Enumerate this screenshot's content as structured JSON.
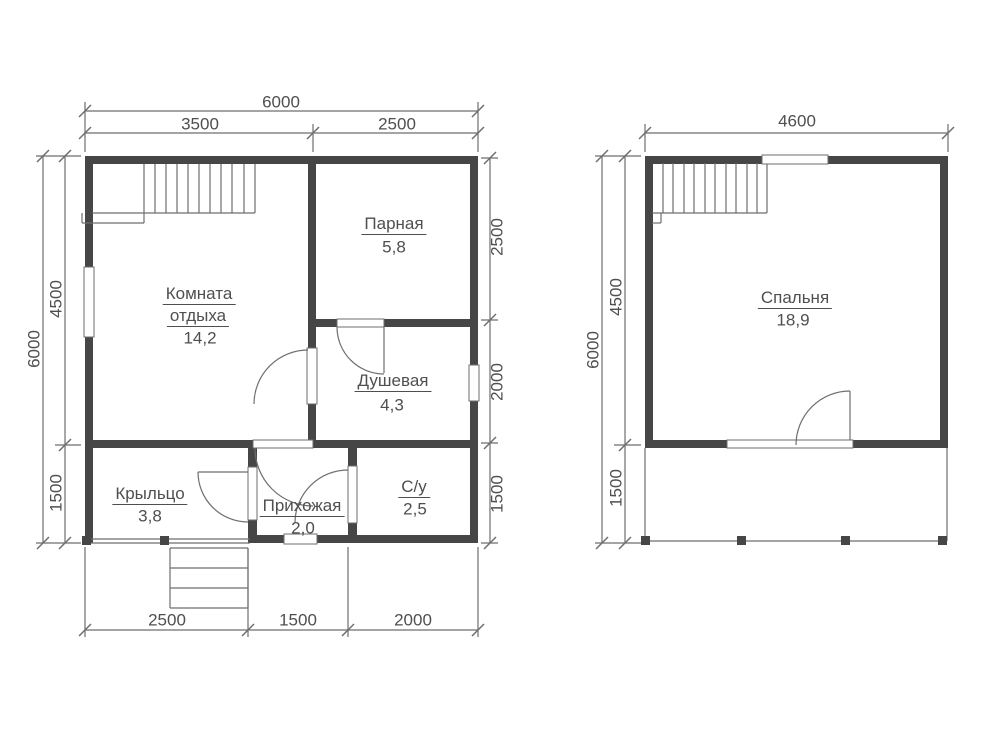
{
  "title": "Floor plans of a 6x6 bath house, two levels",
  "colors": {
    "wall": "#464646",
    "thin": "#6e6e6e",
    "text": "#4f4f4f",
    "window_fill": "#ffffff",
    "bg": "#ffffff"
  },
  "drawing": {
    "walls": [
      {
        "n": "plan1-top-wall",
        "x": 85,
        "y": 156,
        "w": 393,
        "h": 8
      },
      {
        "n": "plan1-left-wall",
        "x": 85,
        "y": 156,
        "w": 8,
        "h": 387
      },
      {
        "n": "plan1-right-wall",
        "x": 470,
        "y": 156,
        "w": 8,
        "h": 387
      },
      {
        "n": "plan1-bottom-wall",
        "x": 250,
        "y": 535,
        "w": 228,
        "h": 8
      },
      {
        "n": "plan1-mid-wall",
        "x": 85,
        "y": 440,
        "w": 393,
        "h": 8
      },
      {
        "n": "plan1-divider-wall",
        "x": 308,
        "y": 156,
        "w": 8,
        "h": 292
      },
      {
        "n": "plan1-sauna-shower-wall",
        "x": 308,
        "y": 319,
        "w": 170,
        "h": 8
      },
      {
        "n": "plan1-hall-left-wall",
        "x": 248,
        "y": 440,
        "w": 9,
        "h": 103
      },
      {
        "n": "plan1-hall-right-wall",
        "x": 348,
        "y": 440,
        "w": 9,
        "h": 103
      },
      {
        "n": "plan2-top-wall",
        "x": 645,
        "y": 156,
        "w": 303,
        "h": 8
      },
      {
        "n": "plan2-left-wall",
        "x": 645,
        "y": 156,
        "w": 8,
        "h": 292
      },
      {
        "n": "plan2-right-wall",
        "x": 940,
        "y": 156,
        "w": 8,
        "h": 292
      },
      {
        "n": "plan2-bottom-wall",
        "x": 645,
        "y": 440,
        "w": 303,
        "h": 8
      }
    ],
    "windows": [
      {
        "n": "window-left",
        "x": 84,
        "y": 267,
        "w": 10,
        "h": 70
      },
      {
        "n": "window-right",
        "x": 469,
        "y": 365,
        "w": 10,
        "h": 36
      },
      {
        "n": "door-opening-lounge-hall",
        "x": 253,
        "y": 440,
        "w": 60,
        "h": 8
      },
      {
        "n": "door-opening-lounge-shower",
        "x": 307,
        "y": 348,
        "w": 10,
        "h": 56
      },
      {
        "n": "door-opening-sauna",
        "x": 337,
        "y": 319,
        "w": 47,
        "h": 8
      },
      {
        "n": "door-opening-wc",
        "x": 348,
        "y": 466,
        "w": 9,
        "h": 57
      },
      {
        "n": "door-opening-porch",
        "x": 248,
        "y": 467,
        "w": 9,
        "h": 53
      },
      {
        "n": "entrance-opening",
        "x": 284,
        "y": 534,
        "w": 33,
        "h": 10
      },
      {
        "n": "window-top-plan2",
        "x": 762,
        "y": 155,
        "w": 66,
        "h": 9
      },
      {
        "n": "door-opening-bedroom",
        "x": 727,
        "y": 440,
        "w": 126,
        "h": 8
      }
    ],
    "posts": [
      {
        "n": "porch-post",
        "x": 82,
        "y": 536,
        "w": 9,
        "h": 9
      },
      {
        "n": "porch-post",
        "x": 160,
        "y": 536,
        "w": 9,
        "h": 9
      },
      {
        "n": "terrace-post",
        "x": 641,
        "y": 536,
        "w": 9,
        "h": 9
      },
      {
        "n": "terrace-post",
        "x": 737,
        "y": 536,
        "w": 9,
        "h": 9
      },
      {
        "n": "terrace-post",
        "x": 841,
        "y": 536,
        "w": 9,
        "h": 9
      },
      {
        "n": "terrace-post",
        "x": 938,
        "y": 536,
        "w": 9,
        "h": 9
      }
    ],
    "lines": [
      {
        "n": "dim-line",
        "x1": 43,
        "y1": 156,
        "x2": 43,
        "y2": 543
      },
      {
        "n": "dim-line",
        "x1": 65,
        "y1": 156,
        "x2": 65,
        "y2": 543
      },
      {
        "n": "dim-line",
        "x1": 85,
        "y1": 111,
        "x2": 478,
        "y2": 111
      },
      {
        "n": "dim-line",
        "x1": 85,
        "y1": 133,
        "x2": 478,
        "y2": 133
      },
      {
        "n": "dim-line",
        "x1": 490,
        "y1": 158,
        "x2": 490,
        "y2": 543
      },
      {
        "n": "dim-line",
        "x1": 85,
        "y1": 630,
        "x2": 478,
        "y2": 630
      },
      {
        "n": "dim-line",
        "x1": 602,
        "y1": 156,
        "x2": 602,
        "y2": 543
      },
      {
        "n": "dim-line",
        "x1": 625,
        "y1": 156,
        "x2": 625,
        "y2": 543
      },
      {
        "n": "dim-line",
        "x1": 645,
        "y1": 133,
        "x2": 948,
        "y2": 133
      },
      {
        "n": "ext-line",
        "x1": 85,
        "y1": 102,
        "x2": 85,
        "y2": 152
      },
      {
        "n": "ext-line",
        "x1": 478,
        "y1": 102,
        "x2": 478,
        "y2": 152
      },
      {
        "n": "ext-line",
        "x1": 313,
        "y1": 124,
        "x2": 313,
        "y2": 152
      },
      {
        "n": "ext-line",
        "x1": 36,
        "y1": 156,
        "x2": 81,
        "y2": 156
      },
      {
        "n": "ext-line",
        "x1": 36,
        "y1": 543,
        "x2": 81,
        "y2": 543
      },
      {
        "n": "ext-line",
        "x1": 55,
        "y1": 445,
        "x2": 81,
        "y2": 445
      },
      {
        "n": "ext-line",
        "x1": 481,
        "y1": 158,
        "x2": 498,
        "y2": 158
      },
      {
        "n": "ext-line",
        "x1": 481,
        "y1": 320,
        "x2": 498,
        "y2": 320
      },
      {
        "n": "ext-line",
        "x1": 481,
        "y1": 443,
        "x2": 498,
        "y2": 443
      },
      {
        "n": "ext-line",
        "x1": 481,
        "y1": 543,
        "x2": 498,
        "y2": 543
      },
      {
        "n": "ext-line",
        "x1": 85,
        "y1": 547,
        "x2": 85,
        "y2": 637
      },
      {
        "n": "ext-line",
        "x1": 248,
        "y1": 548,
        "x2": 248,
        "y2": 637
      },
      {
        "n": "ext-line",
        "x1": 348,
        "y1": 547,
        "x2": 348,
        "y2": 637
      },
      {
        "n": "ext-line",
        "x1": 478,
        "y1": 547,
        "x2": 478,
        "y2": 637
      },
      {
        "n": "ext-line",
        "x1": 645,
        "y1": 124,
        "x2": 645,
        "y2": 152
      },
      {
        "n": "ext-line",
        "x1": 948,
        "y1": 124,
        "x2": 948,
        "y2": 152
      },
      {
        "n": "ext-line",
        "x1": 595,
        "y1": 156,
        "x2": 641,
        "y2": 156
      },
      {
        "n": "ext-line",
        "x1": 595,
        "y1": 543,
        "x2": 641,
        "y2": 543
      },
      {
        "n": "ext-line",
        "x1": 614,
        "y1": 445,
        "x2": 641,
        "y2": 445
      },
      {
        "n": "stair-line",
        "x1": 92,
        "y1": 213,
        "x2": 255,
        "y2": 213
      },
      {
        "n": "stair-line",
        "x1": 255,
        "y1": 164,
        "x2": 255,
        "y2": 213
      },
      {
        "n": "stair-line",
        "x1": 144,
        "y1": 164,
        "x2": 144,
        "y2": 213
      },
      {
        "n": "stair-tread",
        "x1": 155,
        "y1": 164,
        "x2": 155,
        "y2": 213
      },
      {
        "n": "stair-tread",
        "x1": 166,
        "y1": 164,
        "x2": 166,
        "y2": 213
      },
      {
        "n": "stair-tread",
        "x1": 177,
        "y1": 164,
        "x2": 177,
        "y2": 213
      },
      {
        "n": "stair-tread",
        "x1": 188,
        "y1": 164,
        "x2": 188,
        "y2": 213
      },
      {
        "n": "stair-tread",
        "x1": 199,
        "y1": 164,
        "x2": 199,
        "y2": 213
      },
      {
        "n": "stair-tread",
        "x1": 210,
        "y1": 164,
        "x2": 210,
        "y2": 213
      },
      {
        "n": "stair-tread",
        "x1": 221,
        "y1": 164,
        "x2": 221,
        "y2": 213
      },
      {
        "n": "stair-tread",
        "x1": 232,
        "y1": 164,
        "x2": 232,
        "y2": 213
      },
      {
        "n": "stair-tread",
        "x1": 244,
        "y1": 164,
        "x2": 244,
        "y2": 213
      },
      {
        "n": "stair-line",
        "x1": 82,
        "y1": 213,
        "x2": 82,
        "y2": 223
      },
      {
        "n": "stair-line",
        "x1": 82,
        "y1": 223,
        "x2": 144,
        "y2": 223
      },
      {
        "n": "stair-line",
        "x1": 144,
        "y1": 213,
        "x2": 144,
        "y2": 223
      },
      {
        "n": "stair-line",
        "x1": 652,
        "y1": 213,
        "x2": 767,
        "y2": 213
      },
      {
        "n": "stair-line",
        "x1": 767,
        "y1": 163,
        "x2": 767,
        "y2": 213
      },
      {
        "n": "stair-tread",
        "x1": 663,
        "y1": 163,
        "x2": 663,
        "y2": 213
      },
      {
        "n": "stair-tread",
        "x1": 673,
        "y1": 163,
        "x2": 673,
        "y2": 213
      },
      {
        "n": "stair-tread",
        "x1": 684,
        "y1": 163,
        "x2": 684,
        "y2": 213
      },
      {
        "n": "stair-tread",
        "x1": 694,
        "y1": 163,
        "x2": 694,
        "y2": 213
      },
      {
        "n": "stair-tread",
        "x1": 705,
        "y1": 163,
        "x2": 705,
        "y2": 213
      },
      {
        "n": "stair-tread",
        "x1": 715,
        "y1": 163,
        "x2": 715,
        "y2": 213
      },
      {
        "n": "stair-tread",
        "x1": 726,
        "y1": 163,
        "x2": 726,
        "y2": 213
      },
      {
        "n": "stair-tread",
        "x1": 736,
        "y1": 163,
        "x2": 736,
        "y2": 213
      },
      {
        "n": "stair-tread",
        "x1": 747,
        "y1": 163,
        "x2": 747,
        "y2": 213
      },
      {
        "n": "stair-tread",
        "x1": 757,
        "y1": 163,
        "x2": 757,
        "y2": 213
      },
      {
        "n": "stair-line",
        "x1": 652,
        "y1": 223,
        "x2": 661,
        "y2": 223
      },
      {
        "n": "stair-line",
        "x1": 661,
        "y1": 213,
        "x2": 661,
        "y2": 223
      },
      {
        "n": "step-line",
        "x1": 170,
        "y1": 548,
        "x2": 170,
        "y2": 608
      },
      {
        "n": "step-line",
        "x1": 248,
        "y1": 548,
        "x2": 248,
        "y2": 608
      },
      {
        "n": "step-line",
        "x1": 170,
        "y1": 548,
        "x2": 248,
        "y2": 548
      },
      {
        "n": "step-line",
        "x1": 170,
        "y1": 568,
        "x2": 248,
        "y2": 568
      },
      {
        "n": "step-line",
        "x1": 170,
        "y1": 588,
        "x2": 248,
        "y2": 588
      },
      {
        "n": "step-line",
        "x1": 170,
        "y1": 608,
        "x2": 248,
        "y2": 608
      },
      {
        "n": "porch-edge",
        "x1": 85,
        "y1": 539,
        "x2": 250,
        "y2": 539
      },
      {
        "n": "porch-edge",
        "x1": 85,
        "y1": 543,
        "x2": 250,
        "y2": 543
      },
      {
        "n": "terrace-edge",
        "x1": 645,
        "y1": 448,
        "x2": 645,
        "y2": 541
      },
      {
        "n": "terrace-edge",
        "x1": 947,
        "y1": 448,
        "x2": 947,
        "y2": 541
      },
      {
        "n": "terrace-edge",
        "x1": 645,
        "y1": 541,
        "x2": 947,
        "y2": 541
      },
      {
        "n": "door-leaf",
        "x1": 198,
        "y1": 472,
        "x2": 248,
        "y2": 472
      },
      {
        "n": "door-leaf",
        "x1": 384,
        "y1": 327,
        "x2": 384,
        "y2": 373
      },
      {
        "n": "door-leaf",
        "x1": 850,
        "y1": 391,
        "x2": 850,
        "y2": 445
      }
    ],
    "ticks": [
      [
        85,
        111
      ],
      [
        478,
        111
      ],
      [
        85,
        133
      ],
      [
        313,
        133
      ],
      [
        478,
        133
      ],
      [
        43,
        156
      ],
      [
        43,
        543
      ],
      [
        65,
        156
      ],
      [
        65,
        445
      ],
      [
        65,
        543
      ],
      [
        490,
        158
      ],
      [
        490,
        320
      ],
      [
        490,
        443
      ],
      [
        490,
        543
      ],
      [
        85,
        630
      ],
      [
        248,
        630
      ],
      [
        348,
        630
      ],
      [
        478,
        630
      ],
      [
        645,
        133
      ],
      [
        948,
        133
      ],
      [
        602,
        156
      ],
      [
        602,
        543
      ],
      [
        625,
        156
      ],
      [
        625,
        445
      ],
      [
        625,
        543
      ]
    ],
    "arcs": [
      {
        "n": "door-arc-lounge-shower",
        "d": "M308,350 A54,54 0 0 0 254,404"
      },
      {
        "n": "door-arc-sauna",
        "d": "M337,327 A47,47 0 0 0 384,374"
      },
      {
        "n": "door-arc-lounge-hall",
        "d": "M255,448 A58,58 0 0 0 313,506"
      },
      {
        "n": "door-arc-porch",
        "d": "M198,472 A50,50 0 0 0 248,522"
      },
      {
        "n": "door-arc-wc",
        "d": "M348,470 A53,53 0 0 0 295,523"
      },
      {
        "n": "door-arc-bedroom",
        "d": "M850,391 A54,54 0 0 0 796,445"
      }
    ],
    "labels": [
      {
        "n": "room-name-lounge-line1",
        "t": "Комната",
        "x": 199,
        "y": 295,
        "u": 1
      },
      {
        "n": "room-name-lounge-line2",
        "t": "отдыха",
        "x": 198,
        "y": 317,
        "u": 1
      },
      {
        "n": "room-area-lounge",
        "t": "14,2",
        "x": 200,
        "y": 338
      },
      {
        "n": "room-name-sauna",
        "t": "Парная",
        "x": 394,
        "y": 225,
        "u": 1
      },
      {
        "n": "room-area-sauna",
        "t": "5,8",
        "x": 394,
        "y": 247
      },
      {
        "n": "room-name-shower",
        "t": "Душевая",
        "x": 393,
        "y": 382,
        "u": 1
      },
      {
        "n": "room-area-shower",
        "t": "4,3",
        "x": 392,
        "y": 405
      },
      {
        "n": "room-name-porch",
        "t": "Крыльцо",
        "x": 150,
        "y": 495,
        "u": 1
      },
      {
        "n": "room-area-porch",
        "t": "3,8",
        "x": 150,
        "y": 516
      },
      {
        "n": "room-name-hall",
        "t": "Прихожая",
        "x": 302,
        "y": 507,
        "u": 1
      },
      {
        "n": "room-area-hall",
        "t": "2,0",
        "x": 303,
        "y": 528
      },
      {
        "n": "room-name-wc",
        "t": "С/у",
        "x": 414,
        "y": 488,
        "u": 1
      },
      {
        "n": "room-area-wc",
        "t": "2,5",
        "x": 415,
        "y": 509
      },
      {
        "n": "room-name-bedroom",
        "t": "Спальня",
        "x": 795,
        "y": 299,
        "u": 1
      },
      {
        "n": "room-area-bedroom",
        "t": "18,9",
        "x": 793,
        "y": 320
      },
      {
        "n": "dim-top-total",
        "t": "6000",
        "x": 281,
        "y": 102
      },
      {
        "n": "dim-top-left",
        "t": "3500",
        "x": 200,
        "y": 124
      },
      {
        "n": "dim-top-right",
        "t": "2500",
        "x": 397,
        "y": 124
      },
      {
        "n": "dim-left-total",
        "t": "6000",
        "x": 34,
        "y": 349,
        "r": -90
      },
      {
        "n": "dim-left-upper",
        "t": "4500",
        "x": 56,
        "y": 299,
        "r": -90
      },
      {
        "n": "dim-left-lower",
        "t": "1500",
        "x": 56,
        "y": 493,
        "r": -90
      },
      {
        "n": "dim-right-upper",
        "t": "2500",
        "x": 497,
        "y": 237,
        "r": -90
      },
      {
        "n": "dim-right-middle",
        "t": "2000",
        "x": 497,
        "y": 382,
        "r": -90
      },
      {
        "n": "dim-right-lower",
        "t": "1500",
        "x": 497,
        "y": 494,
        "r": -90
      },
      {
        "n": "dim-bottom-left",
        "t": "2500",
        "x": 167,
        "y": 620
      },
      {
        "n": "dim-bottom-middle",
        "t": "1500",
        "x": 298,
        "y": 620
      },
      {
        "n": "dim-bottom-right",
        "t": "2000",
        "x": 413,
        "y": 620
      },
      {
        "n": "dim2-top-total",
        "t": "4600",
        "x": 797,
        "y": 121
      },
      {
        "n": "dim2-left-total",
        "t": "6000",
        "x": 593,
        "y": 350,
        "r": -90
      },
      {
        "n": "dim2-left-upper",
        "t": "4500",
        "x": 616,
        "y": 297,
        "r": -90
      },
      {
        "n": "dim2-left-lower",
        "t": "1500",
        "x": 616,
        "y": 488,
        "r": -90
      }
    ]
  }
}
